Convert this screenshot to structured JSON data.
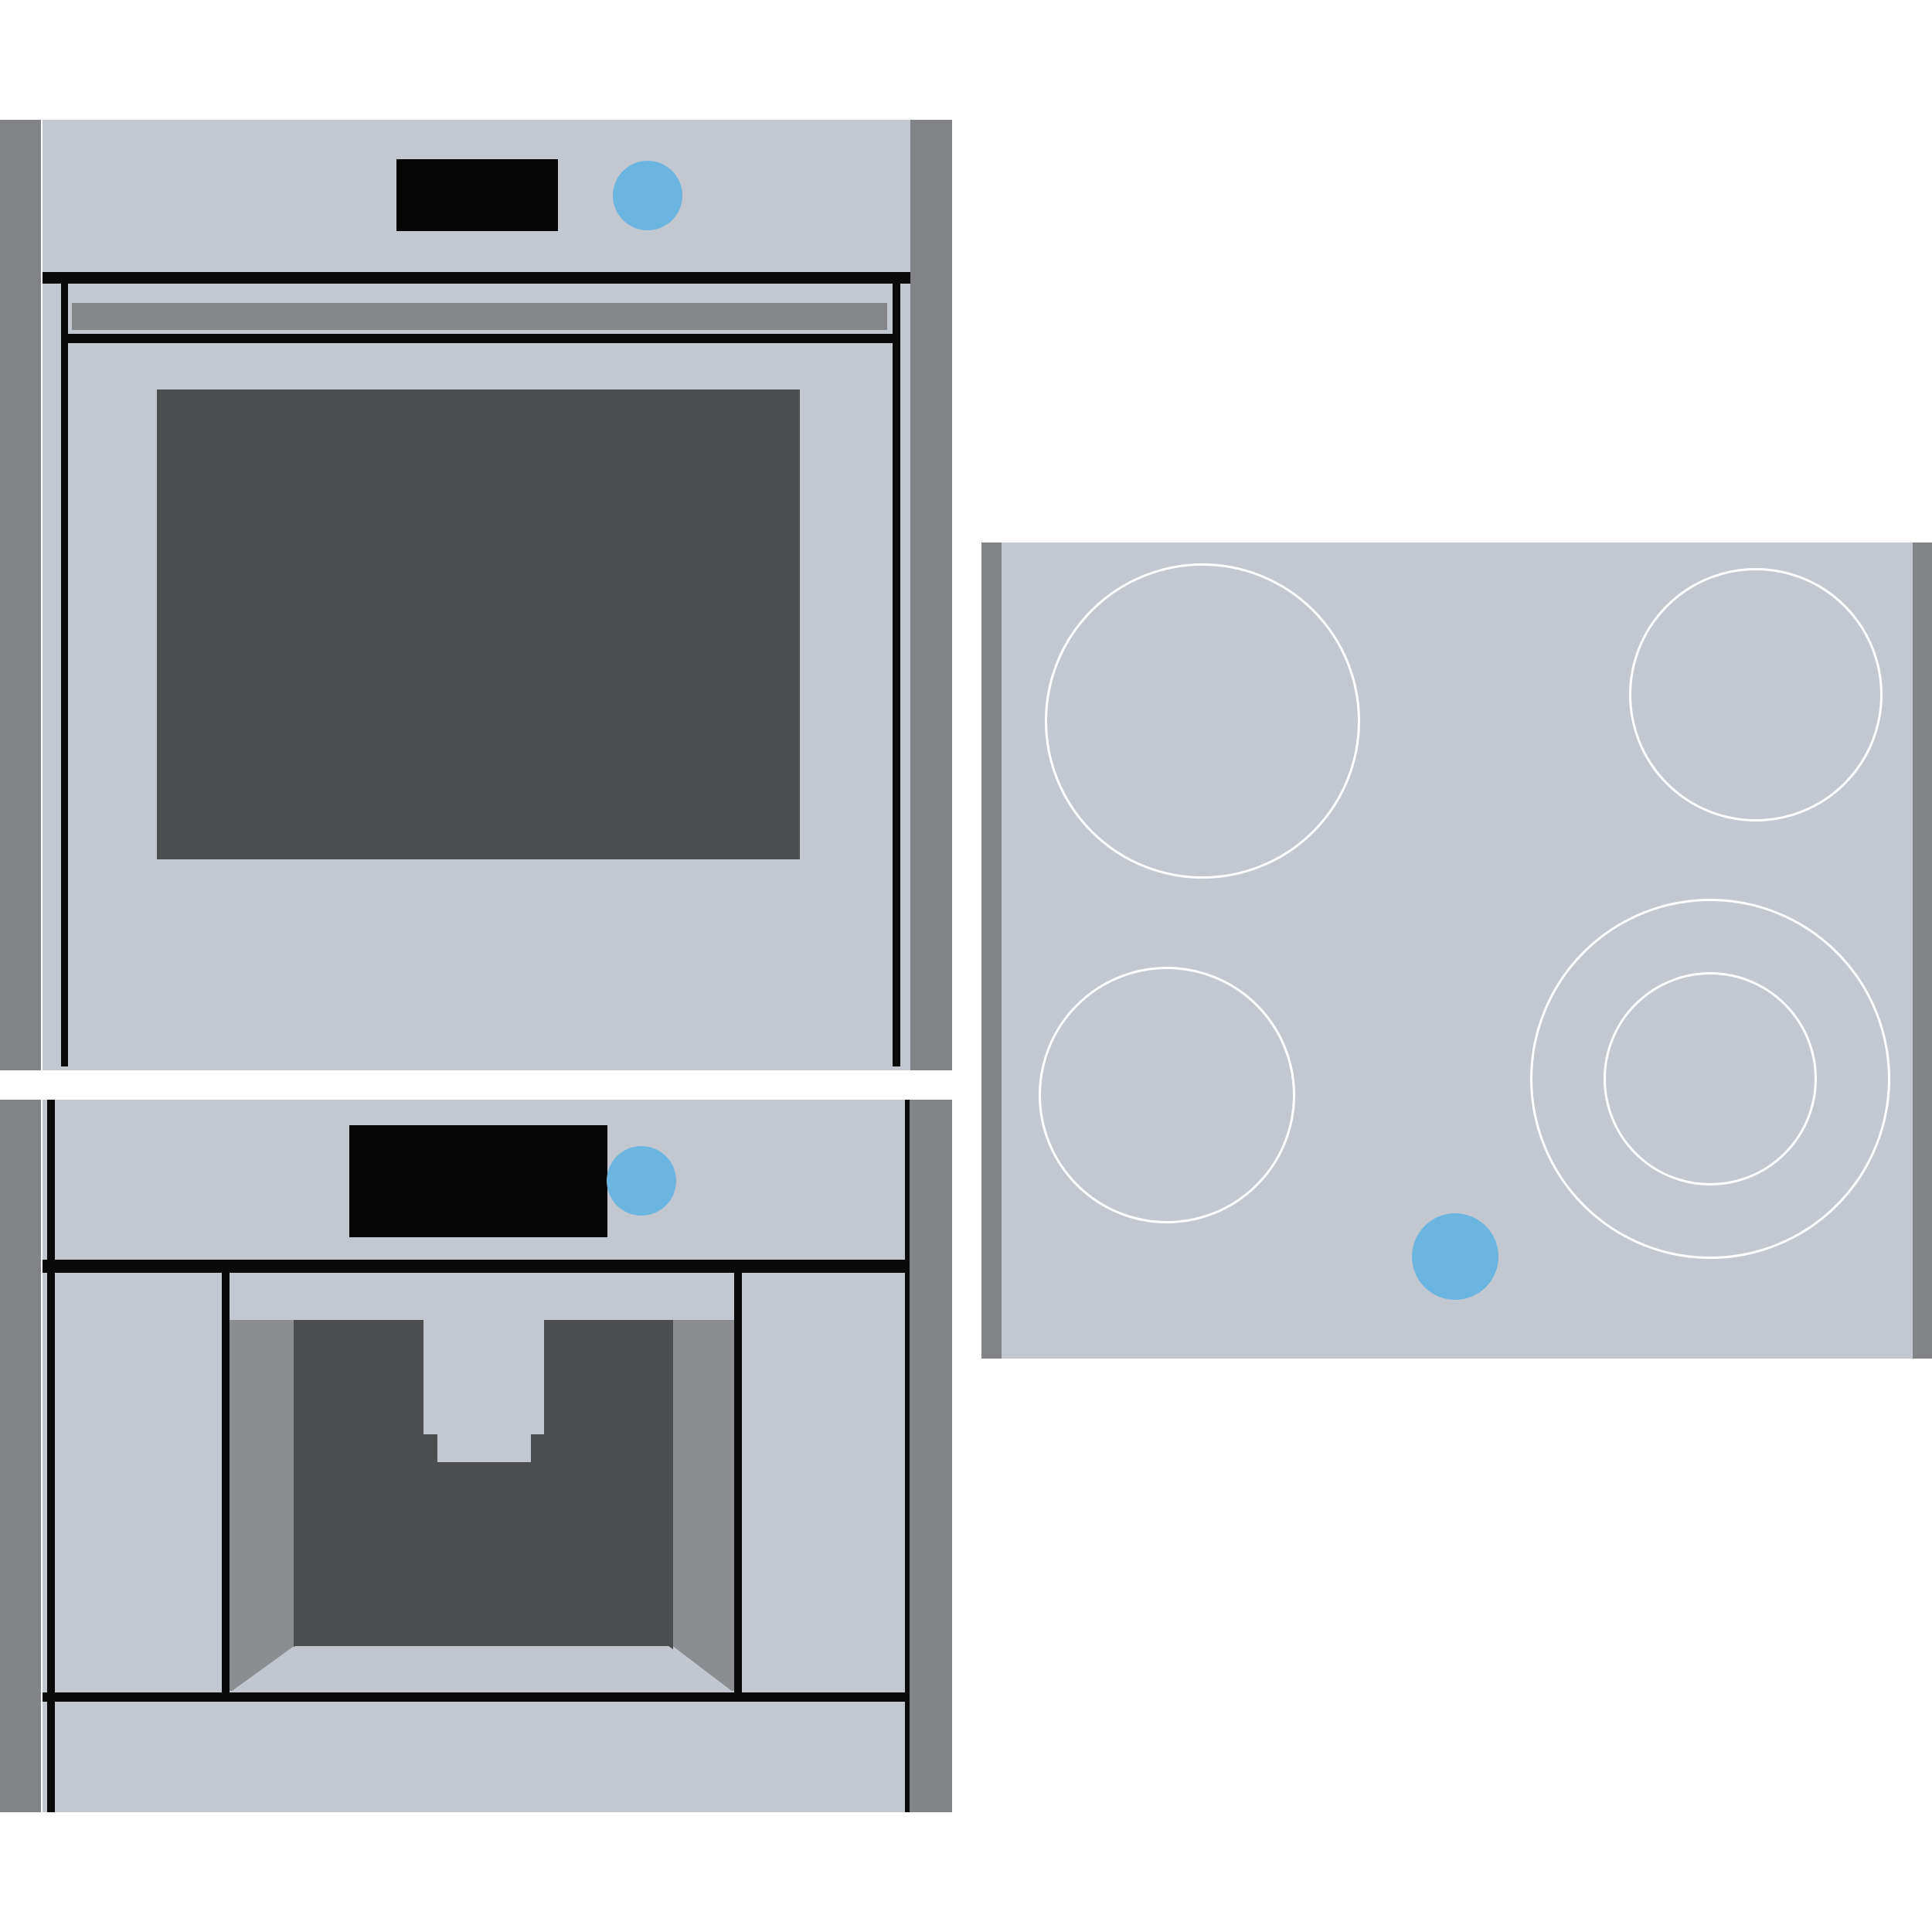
{
  "illustration": {
    "title": "Built-in kitchen appliances illustration",
    "text_content": "none",
    "appliances": [
      {
        "id": "wall-oven",
        "kind": "oven",
        "visible_parts": [
          "cabinet-side-panels",
          "control-panel",
          "blank-black-display",
          "blue-power-knob",
          "door-handle-bar",
          "dark-door-window"
        ]
      },
      {
        "id": "coffee-machine",
        "kind": "built-in coffee machine",
        "visible_parts": [
          "cabinet-side-panels",
          "blank-black-display",
          "blue-power-knob",
          "dispenser-recess",
          "dispenser-spout",
          "drawer-front"
        ]
      },
      {
        "id": "cooktop",
        "kind": "cooktop / hob",
        "burners": [
          {
            "position": "top-left",
            "size": "large",
            "rings": 1
          },
          {
            "position": "top-right",
            "size": "small",
            "rings": 1
          },
          {
            "position": "bottom-left",
            "size": "small",
            "rings": 1
          },
          {
            "position": "bottom-right",
            "size": "large",
            "rings": 2
          }
        ],
        "control": {
          "id": "blue-dot-button",
          "shape": "circle"
        }
      }
    ]
  },
  "palette": {
    "appliance_body": "#c3c8d0",
    "cabinet_side": "#818386",
    "outline_black": "#0a0a0a",
    "display_black": "#050505",
    "accent_blue": "#6cb5e0",
    "oven_window": "#4c4d4f",
    "recess_dark": "#4c4d4f",
    "recess_wall": "#8b8d91",
    "recess_floor": "#c1c6cf",
    "handle_gray": "#85878a",
    "burner_ring_white": "#ffffff"
  }
}
